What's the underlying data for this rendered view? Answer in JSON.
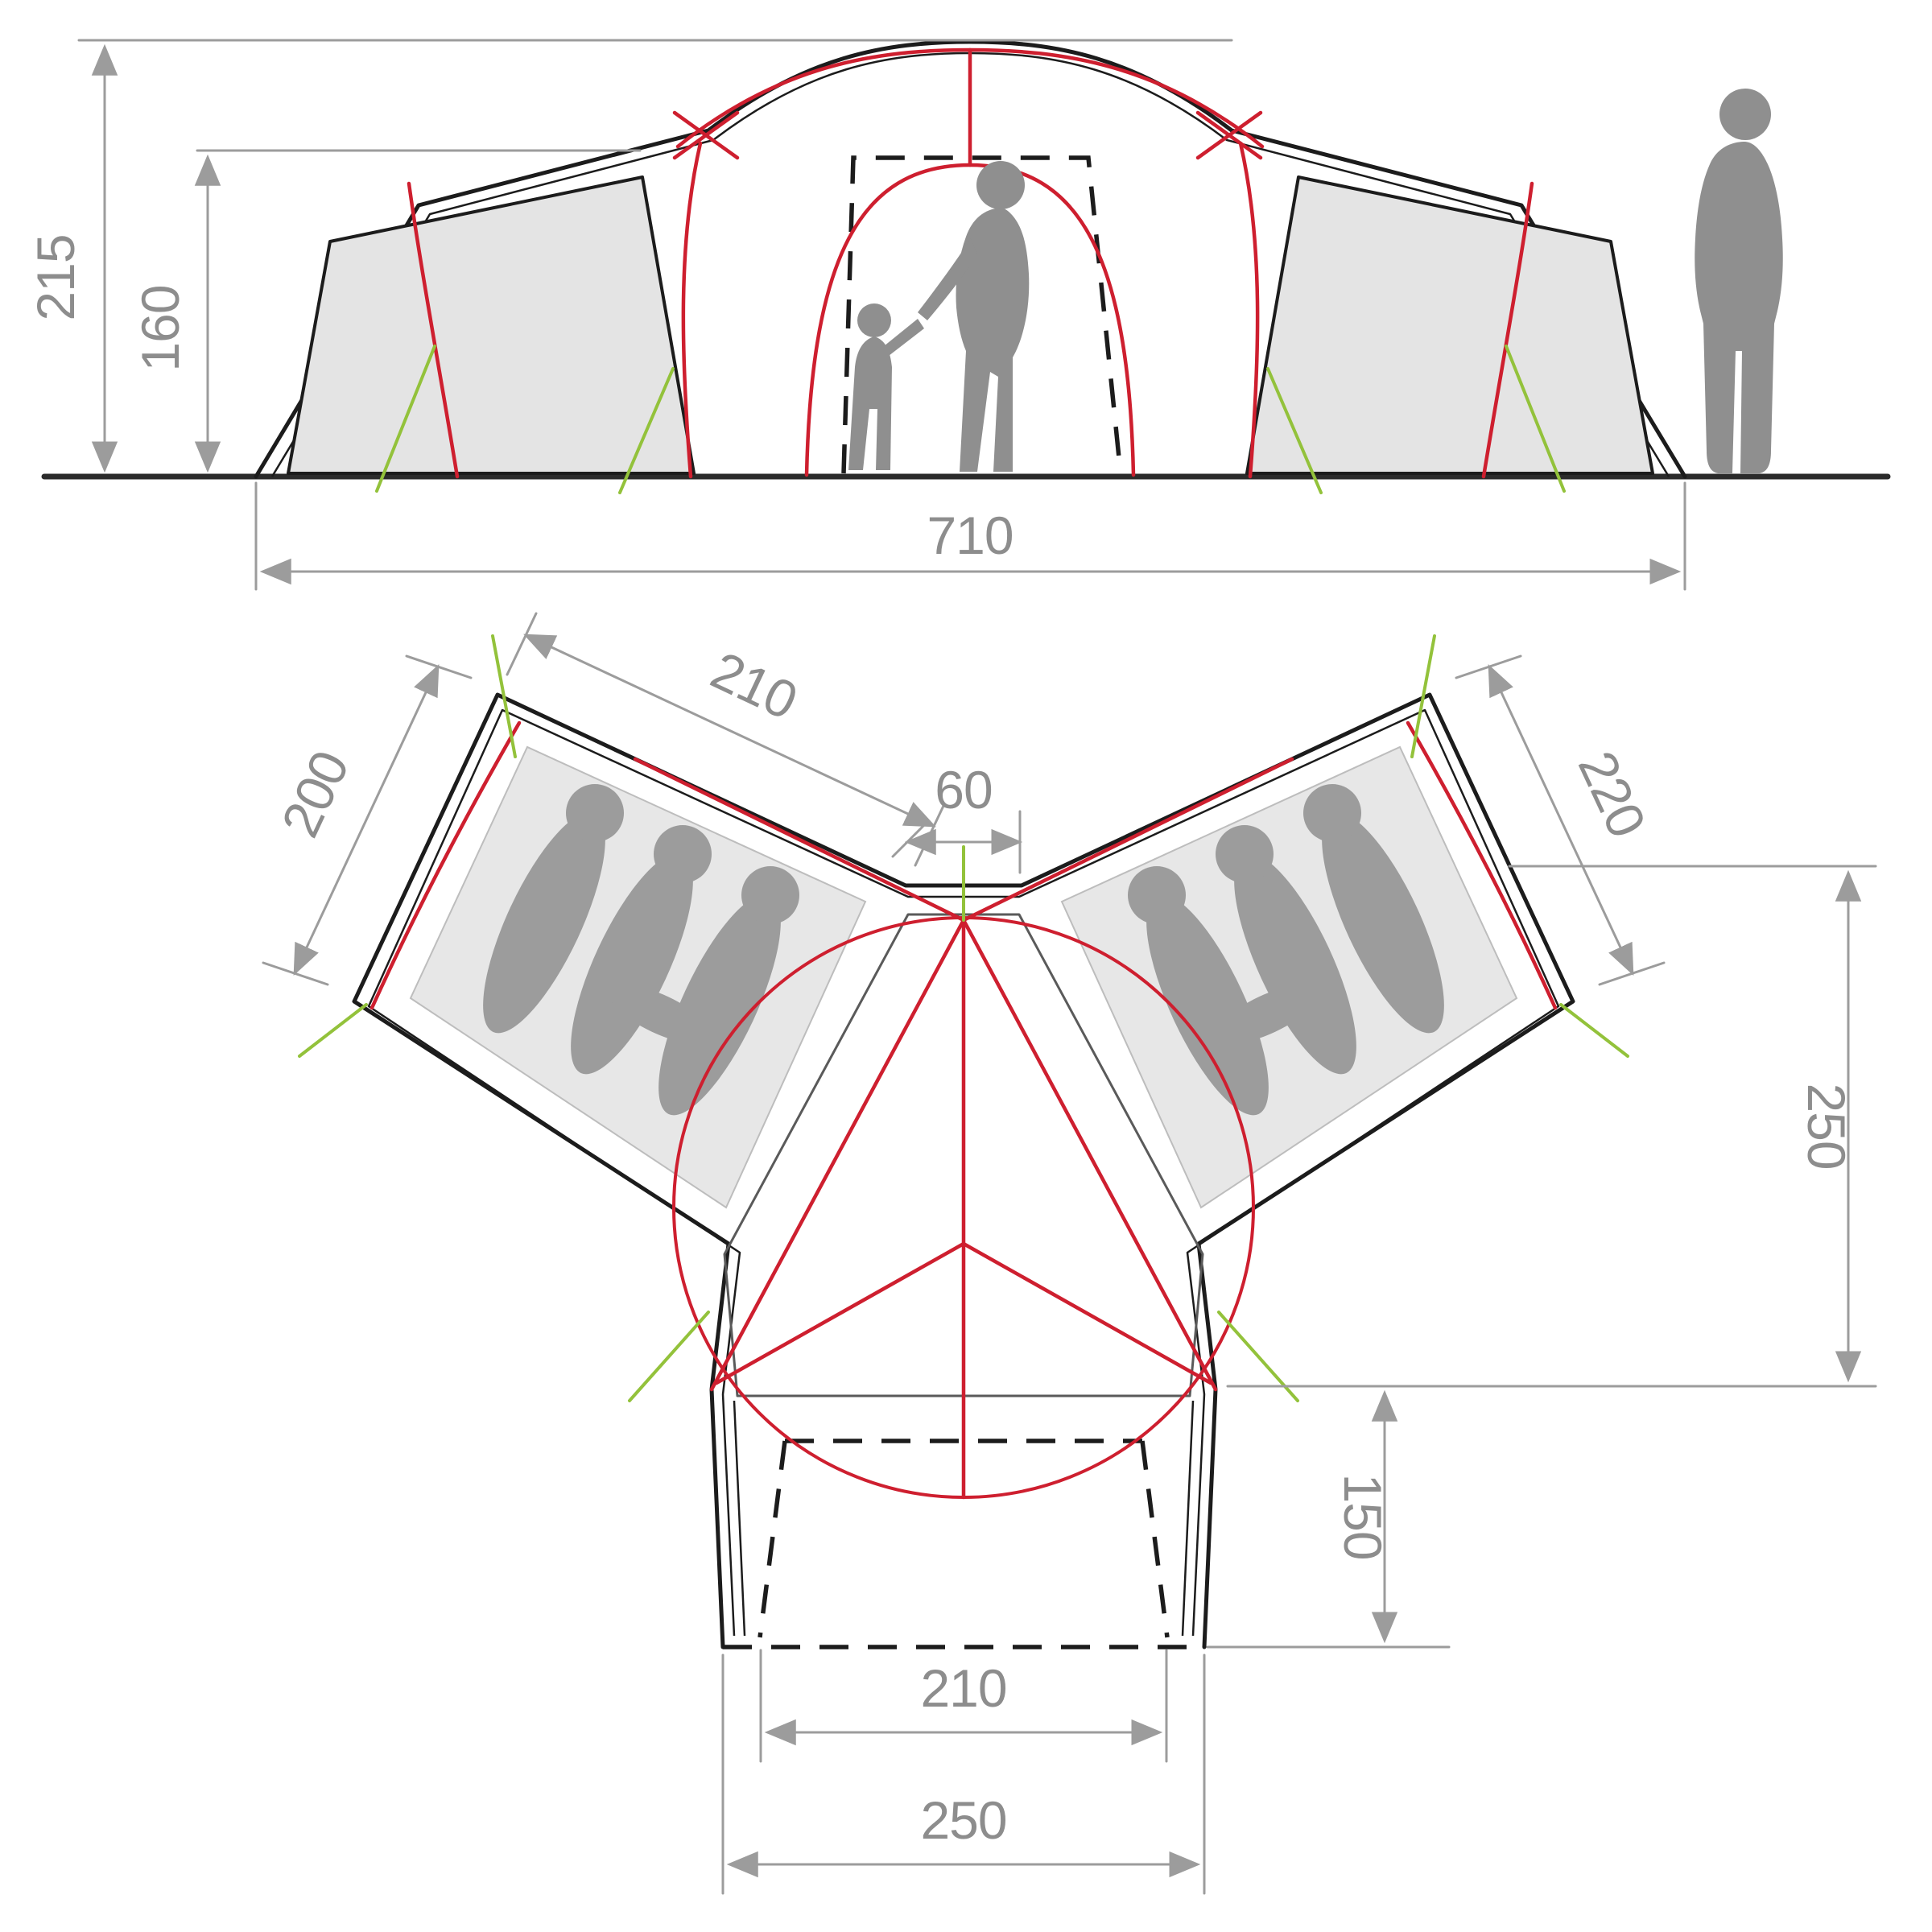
{
  "page": {
    "background": "#ffffff",
    "description": "Tent technical dimension diagram: side elevation above, Y-shaped floor plan below"
  },
  "colors": {
    "outline_black": "#1c1c1c",
    "pole_red": "#ce1f2f",
    "guy_green": "#93c23b",
    "dimension_gray": "#9c9c9c",
    "label_gray": "#8d8d8d",
    "panel_gray": "#e4e4e4",
    "mat_gray": "#e7e7e7",
    "figure_gray": "#8f8f8f",
    "sleeper_gray": "#9c9c9c"
  },
  "elevation": {
    "height_total_cm": "215",
    "height_side_cm": "160",
    "width_total_cm": "710"
  },
  "plan": {
    "left_wing_length_cm": "210",
    "left_wing_width_cm": "200",
    "center_gap_cm": "60",
    "right_wing_length_cm": "220",
    "lounge_depth_cm": "250",
    "porch_depth_cm": "150",
    "porch_inner_width_cm": "210",
    "porch_outer_width_cm": "250"
  }
}
